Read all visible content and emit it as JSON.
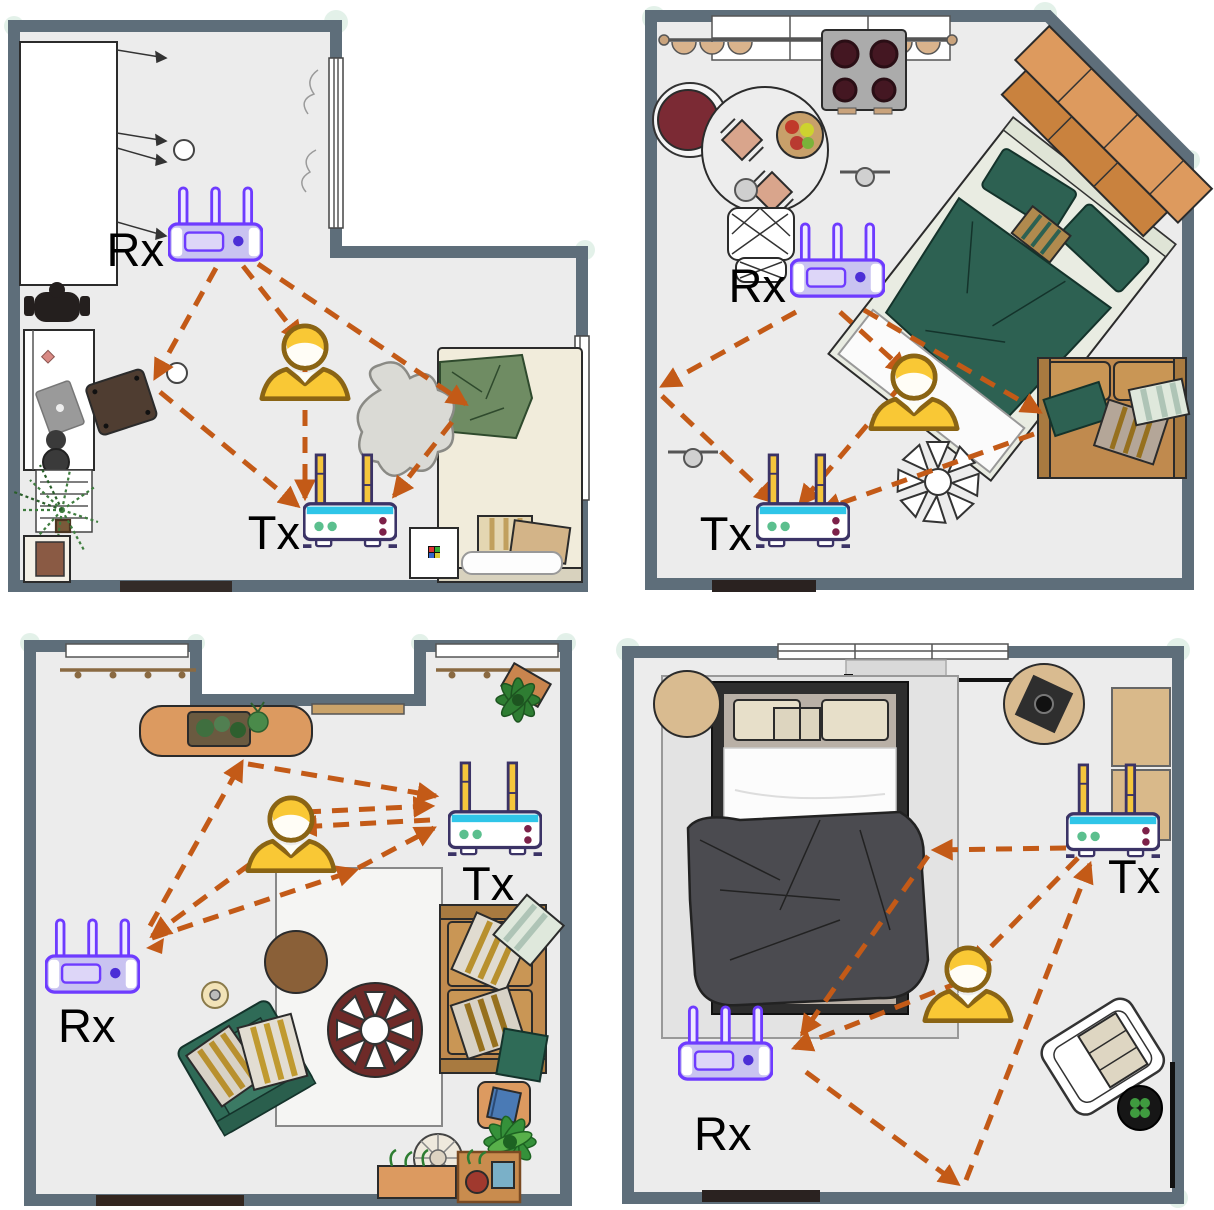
{
  "figure": {
    "type": "indoor-floorplan-multipath-diagram",
    "rooms": [
      {
        "name": "top-left-room",
        "receiver_label": "Rx",
        "transmitter_label": "Tx"
      },
      {
        "name": "top-right-room",
        "receiver_label": "Rx",
        "transmitter_label": "Tx"
      },
      {
        "name": "bottom-left-room",
        "receiver_label": "Rx",
        "transmitter_label": "Tx"
      },
      {
        "name": "bottom-right-room",
        "receiver_label": "Rx",
        "transmitter_label": "Tx"
      }
    ],
    "icons": {
      "receiver": "rx-router-icon",
      "transmitter": "tx-router-icon",
      "person": "person-icon",
      "signal": "signal-path-arrow"
    },
    "colors": {
      "wall": "#5E6E7A",
      "floor": "#ECECEC",
      "background": "#FFFFFF",
      "signal_arrow": "#C35A17",
      "rx_router_outline": "#6E3BFF",
      "rx_router_body": "#C9C3F1",
      "tx_router_outline": "#3B3366",
      "tx_router_accent": "#2FC5E8",
      "tx_router_antenna": "#F5C63C",
      "person_shirt": "#F9C835"
    }
  }
}
